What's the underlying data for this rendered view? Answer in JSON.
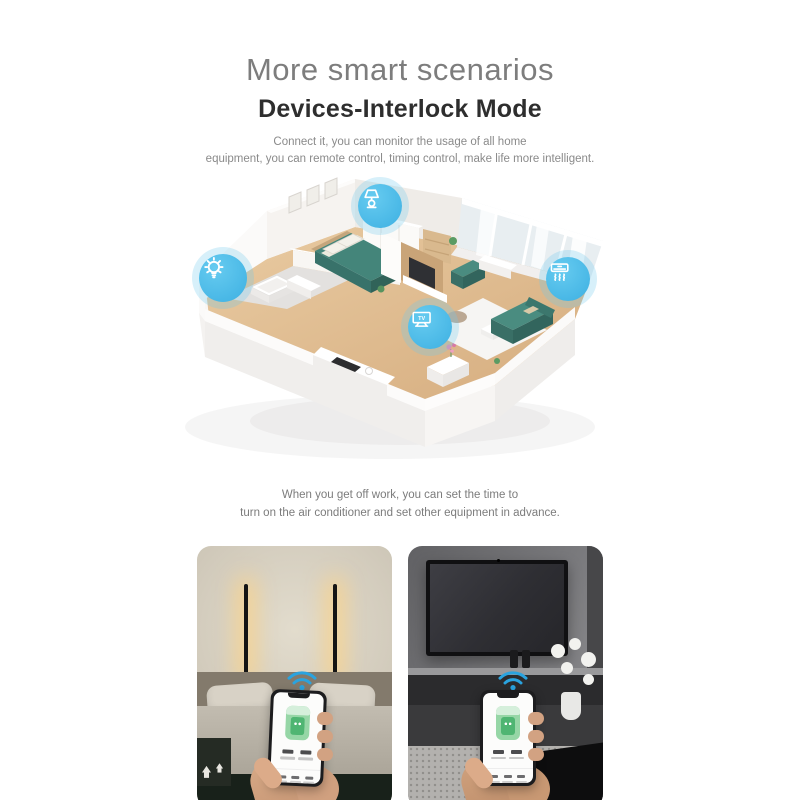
{
  "header": {
    "title": "More smart scenarios",
    "subtitle": "Devices-Interlock Mode",
    "description": [
      "Connect it, you can monitor the usage of all home",
      "equipment, you can remote control, timing control, make life more intelligent."
    ]
  },
  "floorplan": {
    "badges": [
      {
        "icon": "light-bulb-icon",
        "device": "ceiling-light"
      },
      {
        "icon": "table-lamp-icon",
        "device": "bedside-lamp"
      },
      {
        "icon": "air-conditioner-icon",
        "device": "air-conditioner"
      },
      {
        "icon": "tv-icon",
        "device": "television",
        "label": "TV"
      }
    ],
    "colors": {
      "badge_blue": "#46b8e7",
      "furniture_teal": "#41837a",
      "wood_floor": "#dfbd92",
      "wall_white": "#f7f5f2"
    }
  },
  "caption": [
    "When you get off work, you can set the time to",
    "turn on the air conditioner and set other equipment in advance."
  ],
  "photos": [
    {
      "scene": "bedroom-wall-lamps",
      "overlay_icon": "wifi-icon"
    },
    {
      "scene": "living-room-tv",
      "overlay_icon": "wifi-icon"
    }
  ]
}
